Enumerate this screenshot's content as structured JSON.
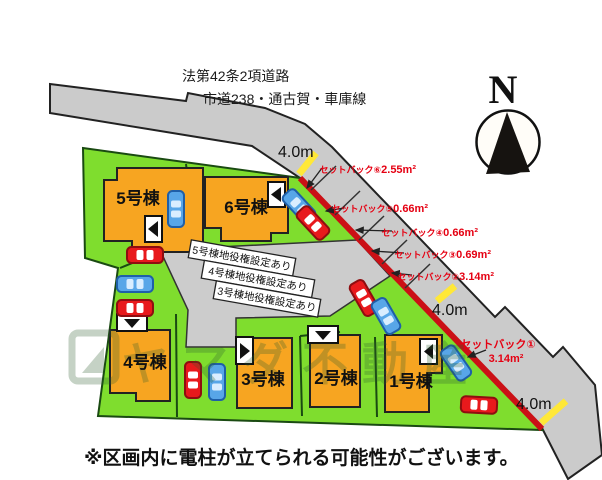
{
  "map": {
    "road": {
      "law_label": "法第42条2項道路",
      "route_label": "市道238・通古賀・車庫線",
      "width_labels": [
        "4.0m",
        "4.0m",
        "4.0m"
      ]
    },
    "compass": {
      "north_label": "N"
    },
    "plots": [
      {
        "id": "5",
        "label": "5号棟"
      },
      {
        "id": "6",
        "label": "6号棟"
      },
      {
        "id": "4",
        "label": "4号棟"
      },
      {
        "id": "3",
        "label": "3号棟"
      },
      {
        "id": "2",
        "label": "2号棟"
      },
      {
        "id": "1",
        "label": "1号棟"
      }
    ],
    "easement_labels": [
      "5号棟地役権設定あり",
      "4号棟地役権設定あり",
      "3号棟地役権設定あり"
    ],
    "setbacks": [
      {
        "label": "セットバック⑥",
        "area": "2.55m²"
      },
      {
        "label": "セットバック⑤",
        "area": "0.66m²"
      },
      {
        "label": "セットバック④",
        "area": "0.66m²"
      },
      {
        "label": "セットバック③",
        "area": "0.69m²"
      },
      {
        "label": "セットバック②",
        "area": "3.14m²"
      },
      {
        "label": "セットバック①",
        "area": "3.14m²"
      }
    ],
    "watermark": "ヤマダ不動産",
    "note": "※区画内に電柱が立てられる可能性がございます。"
  },
  "colors": {
    "plot_green": "#7fdd2e",
    "building_orange": "#f7a521",
    "road_gray": "#cbcbcb",
    "easement_gray": "#cccccc",
    "setback_red_line": "#cb1016",
    "marker_yellow": "#ffe838",
    "label_red": "#e50012",
    "car_red": "#e8191c",
    "car_blue": "#58a6e8"
  }
}
